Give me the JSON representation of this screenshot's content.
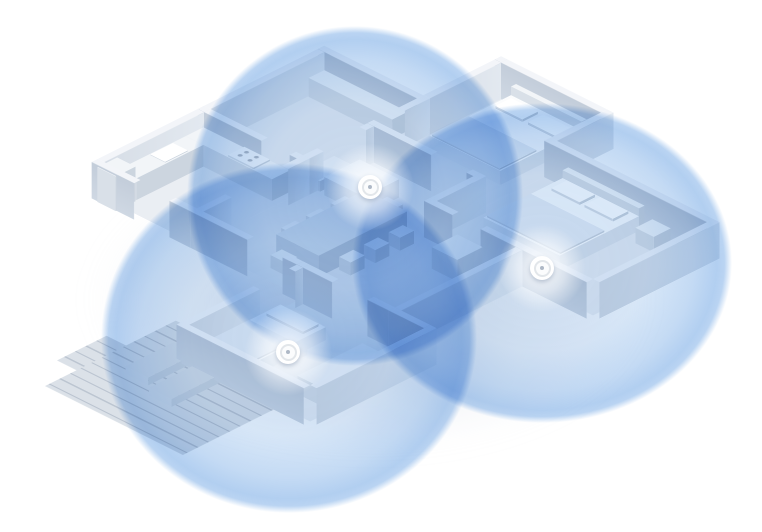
{
  "scene": {
    "description": "Isometric 3D cutaway floor plan of a home with three mesh Wi-Fi routers and their overlapping circular coverage zones",
    "background_color": "#ffffff"
  },
  "coverage": {
    "zone_fill_color": "#84b4e9",
    "overlap_blend_mode": "multiply",
    "zones": [
      {
        "id": "coverage-zone-top",
        "cx": 355,
        "cy": 196,
        "rx": 168,
        "ry": 170
      },
      {
        "id": "coverage-zone-bottom-left",
        "cx": 289,
        "cy": 338,
        "rx": 188,
        "ry": 175
      },
      {
        "id": "coverage-zone-right",
        "cx": 542,
        "cy": 263,
        "rx": 190,
        "ry": 160
      }
    ]
  },
  "devices": {
    "marker_color": "#ffffff",
    "items": [
      {
        "id": "router-living-area",
        "x": 370,
        "y": 187
      },
      {
        "id": "router-bedroom-right",
        "x": 542,
        "y": 268
      },
      {
        "id": "router-bedroom-left",
        "x": 288,
        "y": 352
      }
    ]
  }
}
